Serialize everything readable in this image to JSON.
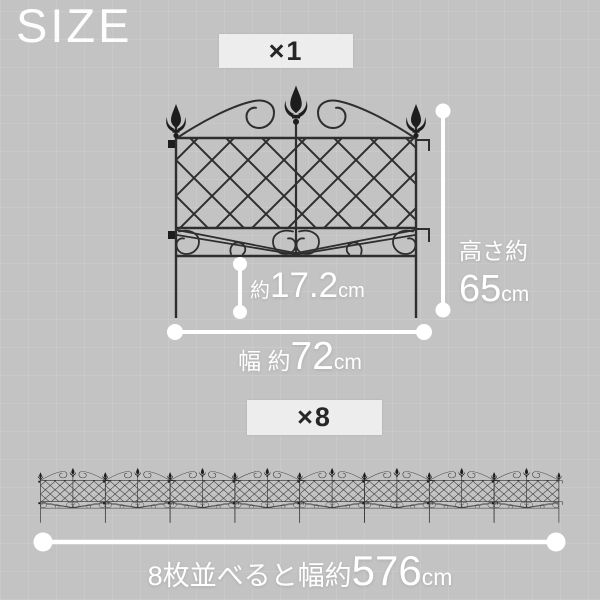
{
  "page": {
    "title": "SIZE"
  },
  "single_fence_section": {
    "badge": "×1",
    "height_label": "高さ約",
    "height_value": "65",
    "height_unit": "cm",
    "stake_prefix": "約",
    "stake_value": "17.2",
    "stake_unit": "cm",
    "width_prefix": "幅 約",
    "width_value": "72",
    "width_unit": "cm"
  },
  "row_section": {
    "badge": "×8",
    "panel_count": 8,
    "label_prefix": "8枚並べると幅約",
    "label_value": "576",
    "label_unit": "cm"
  },
  "icons": {
    "fence_finial": "fleur-de-lis-finial-icon",
    "dimension_marker": "round-endpoint-dimension-line"
  },
  "colors": {
    "background": "#c3c3c4",
    "grid_line": "rgba(255,255,255,0.10)",
    "badge_background": "#ededed",
    "badge_text": "#262626",
    "fence_iron": "#2e2e2e",
    "dimension_line": "#ffffff",
    "label_text": "#ffffff"
  }
}
